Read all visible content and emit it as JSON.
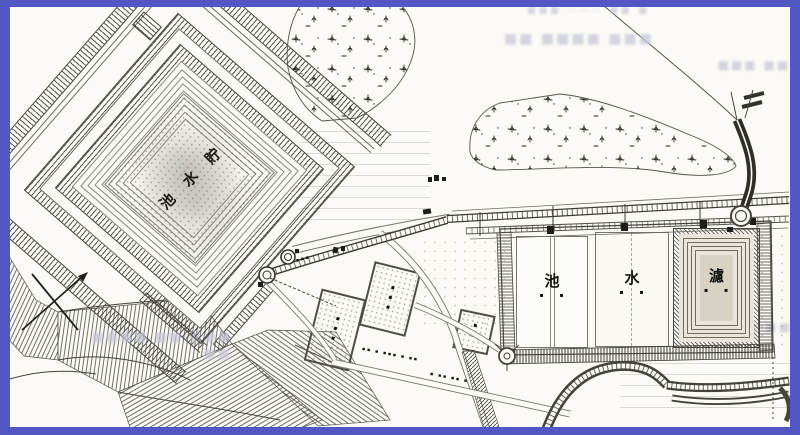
{
  "frame": {
    "color": "#5257c4",
    "paper": "#fbfaf6"
  },
  "labels": {
    "reservoir": "貯水池",
    "ponds_reading": "濾水池",
    "ponds": [
      {
        "char": "池",
        "marks": "▪ ▪"
      },
      {
        "char": "水",
        "marks": "▪ ▪"
      },
      {
        "char": "濾",
        "marks": "▪ ▪"
      }
    ],
    "plots": {
      "p1": "▪▪▪",
      "p2": "▪▪▪",
      "p3": "▪▪"
    },
    "tiny": {
      "road_a": "▪▪ ▪ ▪▪▪ ▪ ▪▪",
      "road_b": "▪ ▪▪ ▪▪ ▪",
      "wells": "▪▪▪"
    }
  },
  "artifacts": {
    "ghost_top_small": "■ ■■ ——— ■■■",
    "ghost_top": "■■■ ■■■■ ■■",
    "ghost_right": "■■ ■■■",
    "ghost_bottom_left": "■■■ ■■ ■■■■ ■■",
    "ghost_right_mid": "■■ ■■"
  }
}
